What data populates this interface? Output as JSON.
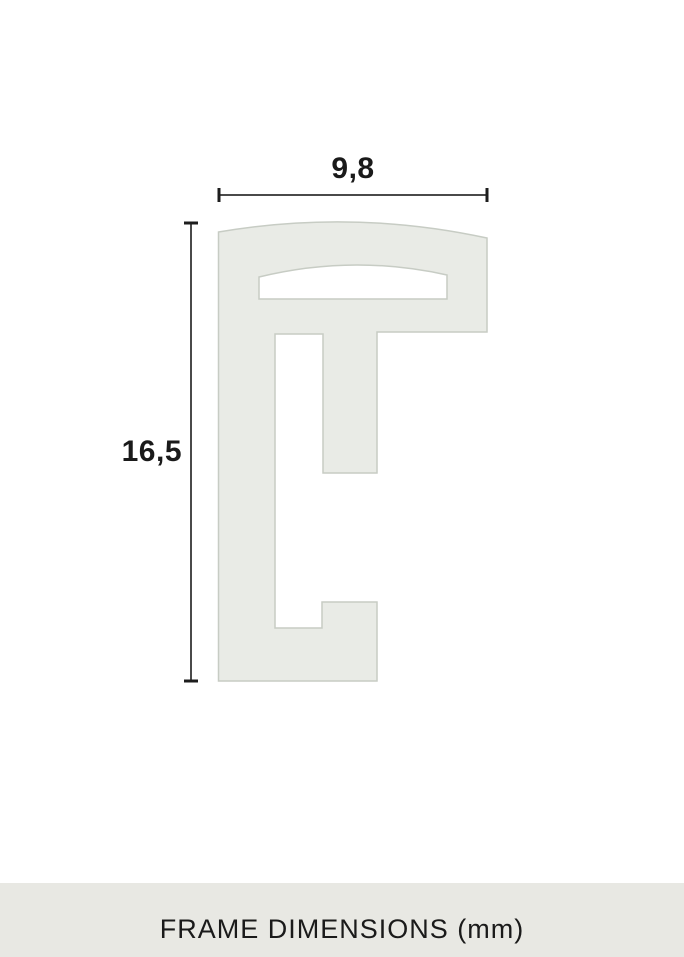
{
  "diagram": {
    "width_dimension": {
      "label": "9,8"
    },
    "height_dimension": {
      "label": "16,5"
    }
  },
  "footer": {
    "caption": "FRAME DIMENSIONS (mm)"
  },
  "colors": {
    "background": "#ffffff",
    "profile_fill": "#e9ebe6",
    "profile_stroke": "#c7ccc4",
    "dimension_line": "#4a4a4a",
    "dimension_tick": "#1d1d1d",
    "text": "#1a1a1a",
    "footer_bg": "#e8e8e3"
  }
}
